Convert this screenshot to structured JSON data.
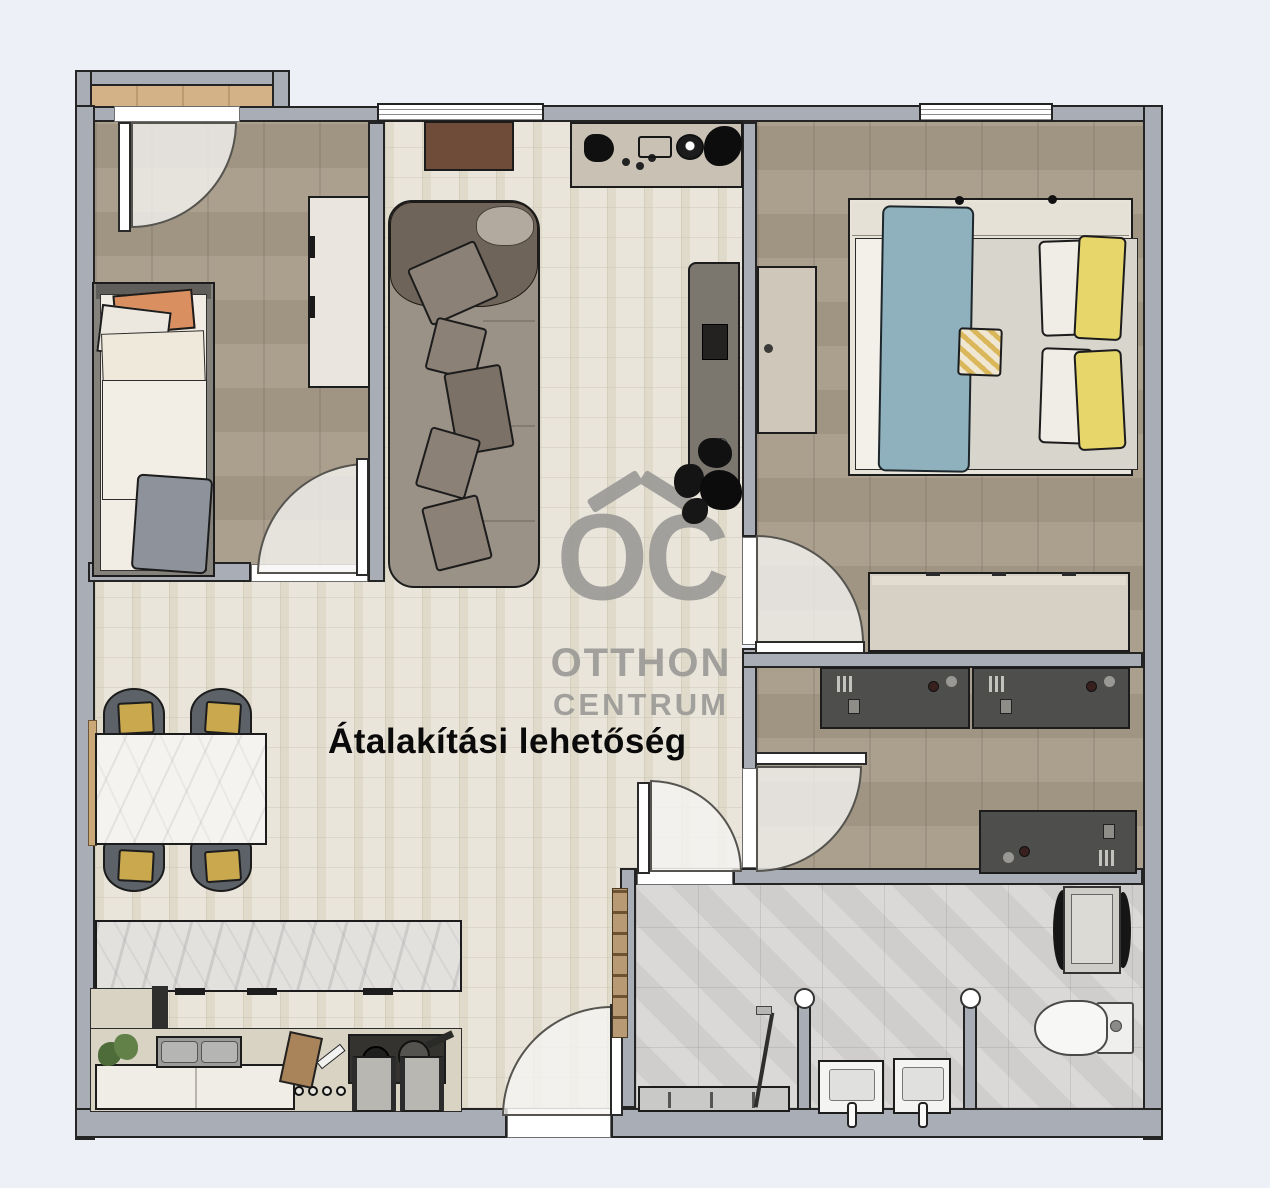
{
  "floorplan": {
    "annotation": "Átalakítási lehetőség",
    "watermark": {
      "monogram": "OC",
      "line1": "OTTHON",
      "line2": "CENTRUM"
    },
    "colors": {
      "background": "#eef0f7",
      "wall_fill": "#a9adb5",
      "wall_outline": "#242424",
      "wood_floor": "#a79a88",
      "tile_floor": "#e9e5db",
      "bath_floor": "#d6d5d3",
      "balcony_floor": "#d4b287",
      "sofa": "#9a9187",
      "sofa_blanket": "#6f6459",
      "dining_cushion_gold": "#c9a84e",
      "bed_blanket_blue": "#8fb1bd",
      "bed_pillow_yellow": "#e7d76b",
      "bed_pillow_orange": "#d98f60",
      "desk_dark": "#4e4e4c",
      "marble": "#f4f2ee",
      "watermark_grey": "#9b9b97",
      "annotation_text": "#0a0a0a"
    },
    "furniture_icons": [
      "single-bed-icon",
      "wardrobe-icon",
      "balcony-icon",
      "sofa-icon",
      "doormat-icon",
      "sideboard-icon",
      "tv-cabinet-icon",
      "plant-icon",
      "double-bed-icon",
      "bedside-console-icon",
      "dresser-icon",
      "desk-icon",
      "dining-table-icon",
      "dining-chair-icon",
      "kitchen-island-icon",
      "kitchen-counter-icon",
      "kitchen-sink-icon",
      "stove-icon",
      "bar-stool-icon",
      "shower-icon",
      "washbasin-icon",
      "toilet-icon",
      "washing-machine-icon",
      "door-swing-icon",
      "window-icon"
    ]
  }
}
